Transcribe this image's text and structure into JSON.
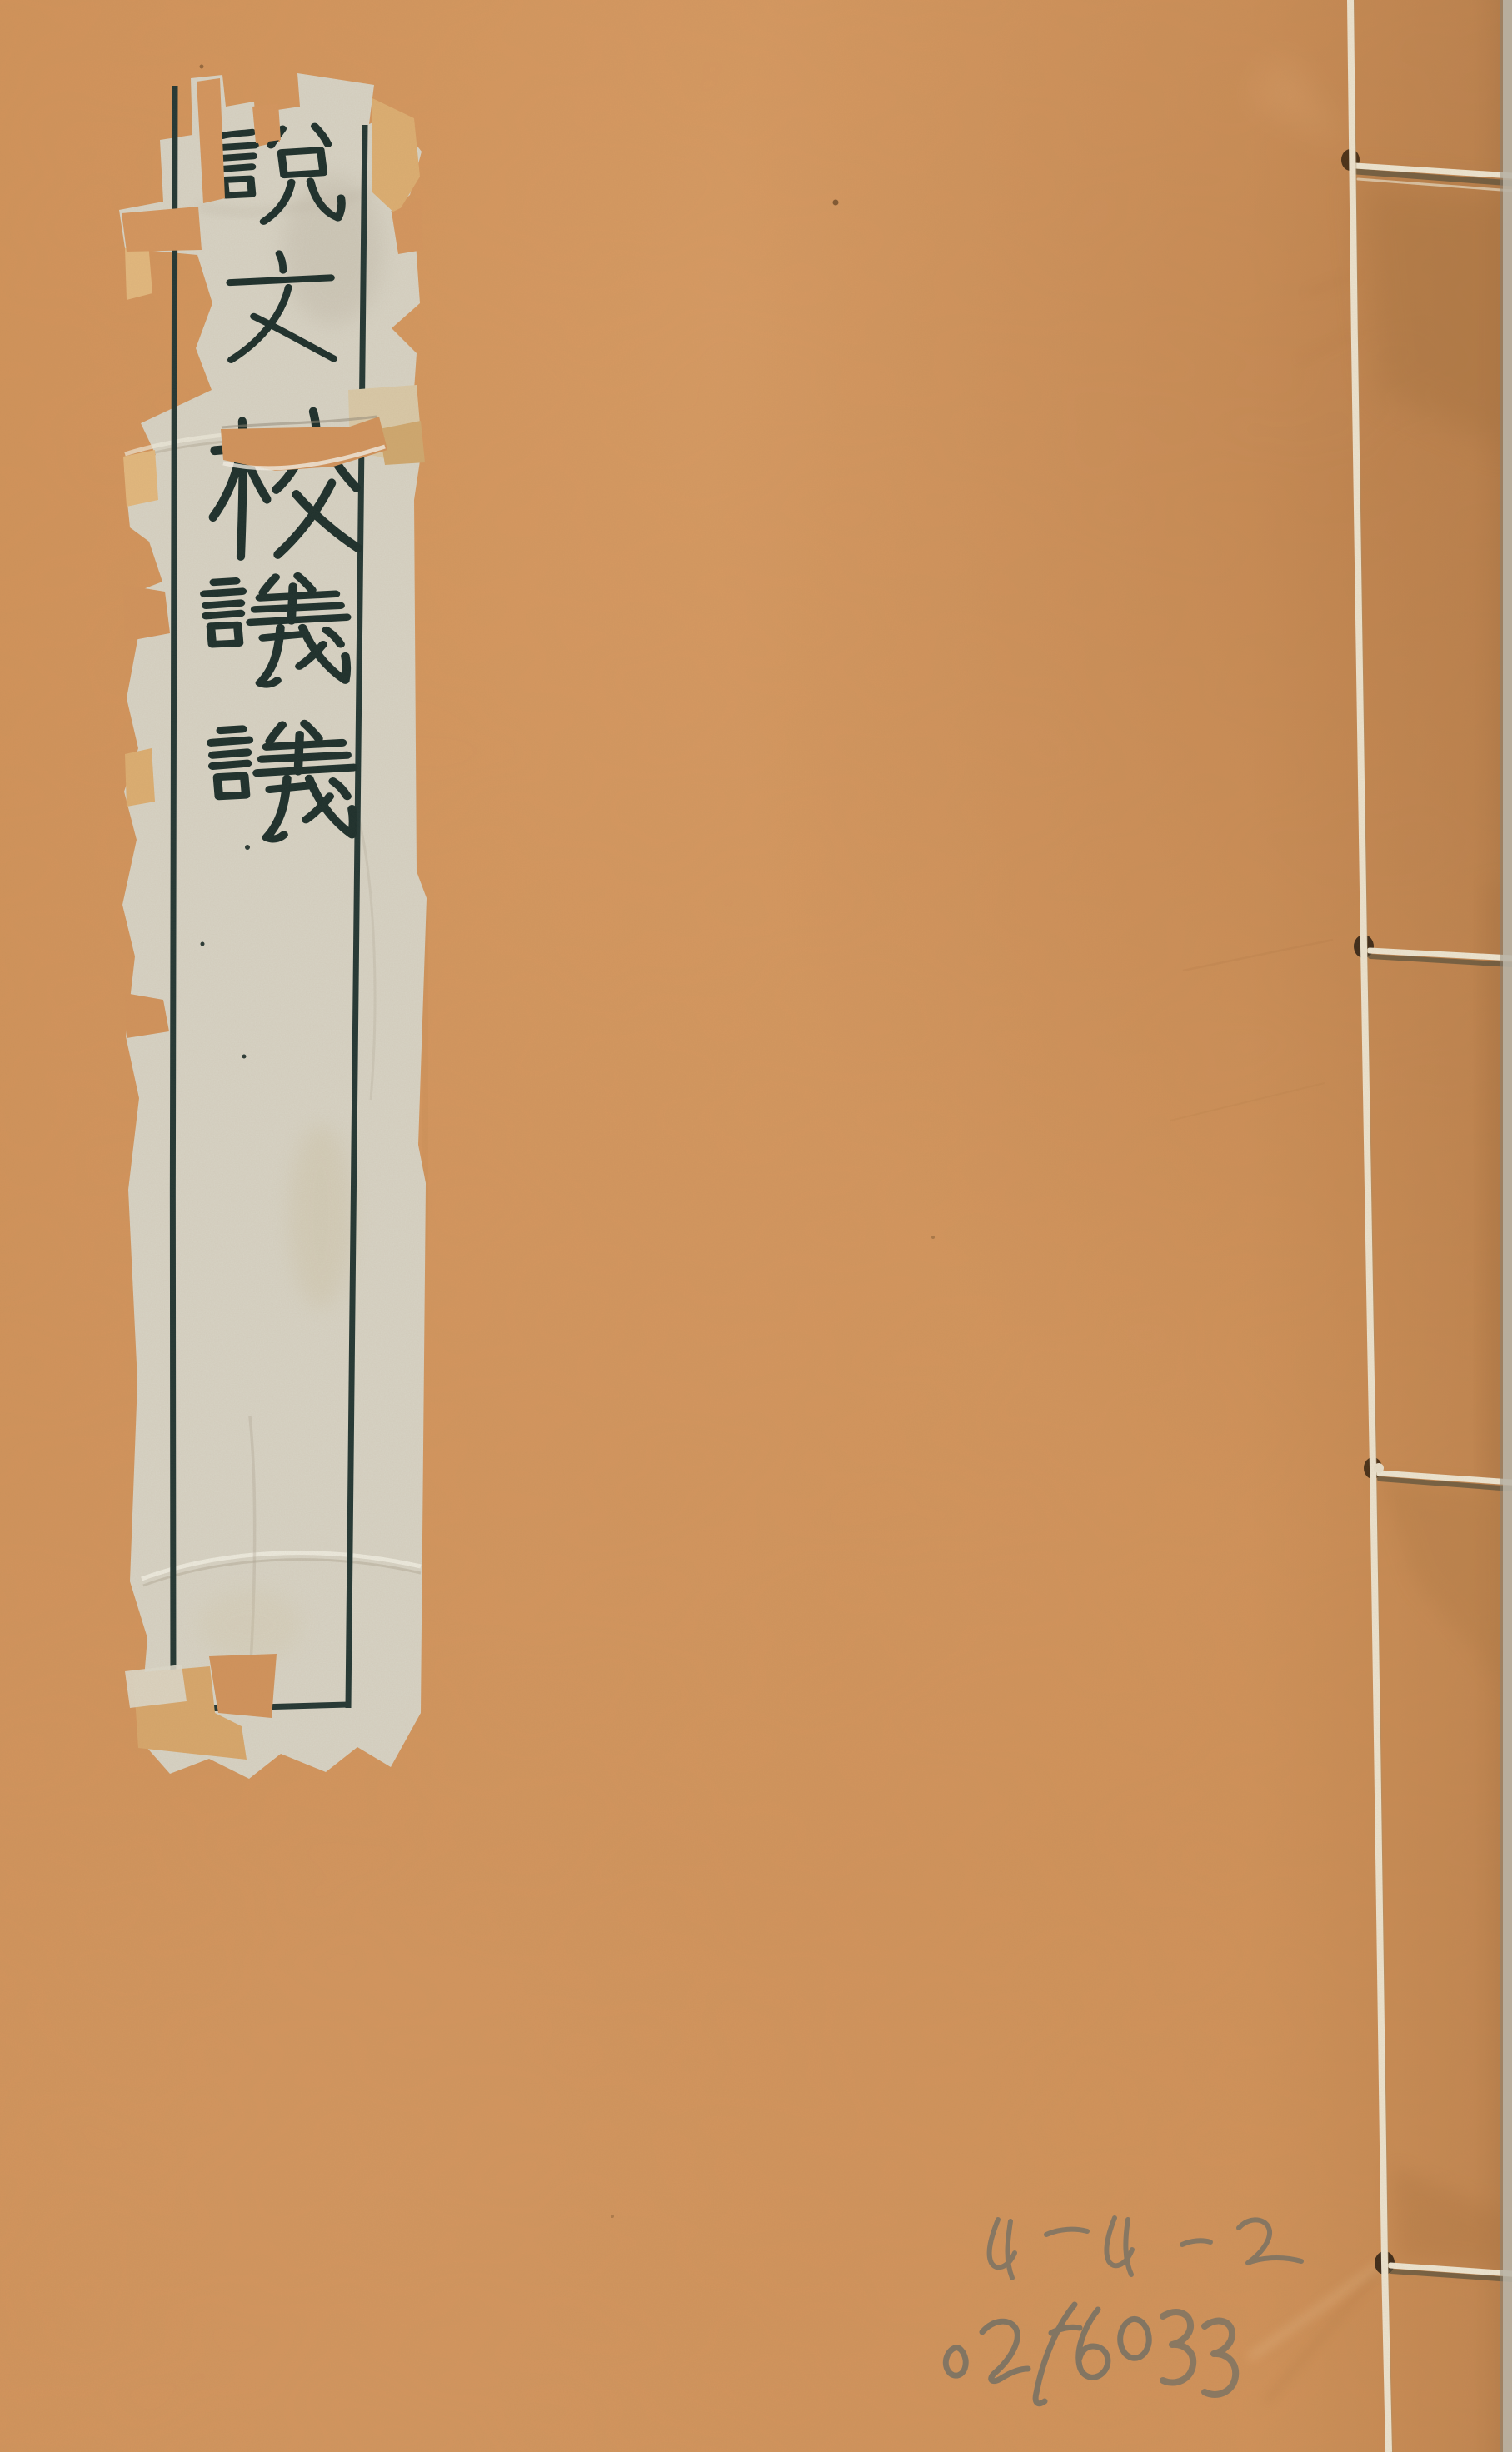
{
  "cover": {
    "title_label": {
      "text": "說文校議議",
      "characters": [
        "說",
        "文",
        "校",
        "議",
        "議"
      ],
      "orientation": "vertical"
    },
    "handwritten_annotations": {
      "line1": "4-4-2",
      "line2": "0256033"
    },
    "binding": {
      "stitch_count": 4
    },
    "colors": {
      "cover_paper": "#d09158",
      "label_paper": "#d7d3c5",
      "ink": "#1d302d",
      "tape": "#d9ab72",
      "thread": "#ece3cf",
      "stitch_hole": "#4a3118",
      "pencil": "#6e6e66",
      "scan_edge": "#b8b2a5"
    }
  }
}
